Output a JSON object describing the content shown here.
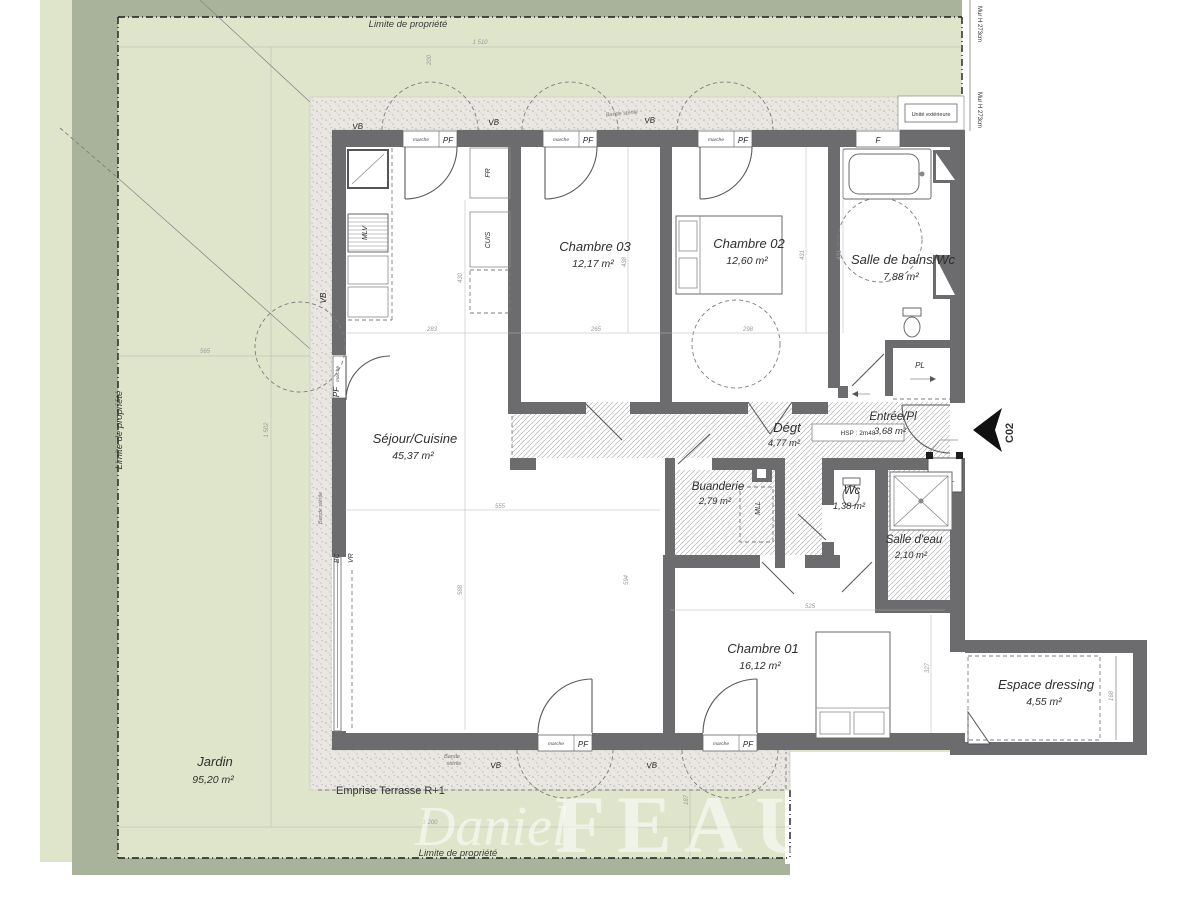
{
  "plan": {
    "code": "C02"
  },
  "garden": {
    "name": "Jardin",
    "area": "95,20 m²",
    "limite": "Limite de propriété",
    "emprise": "Emprise Terrasse R+1",
    "unite_exterieure": "Unité extérieure",
    "mur": "Mur H 273cm"
  },
  "rooms": [
    {
      "name": "Séjour/Cuisine",
      "area": "45,37 m²"
    },
    {
      "name": "Chambre 03",
      "area": "12,17 m²"
    },
    {
      "name": "Chambre 02",
      "area": "12,60 m²"
    },
    {
      "name": "Salle de bains/Wc",
      "area": "7,88 m²"
    },
    {
      "name": "Dégt",
      "area": "4,77 m²"
    },
    {
      "name": "Entrée/Pl",
      "area": "3,68 m²"
    },
    {
      "name": "Buanderie",
      "area": "2,79 m²"
    },
    {
      "name": "Wc",
      "area": "1,38 m²"
    },
    {
      "name": "Salle d'eau",
      "area": "2,10 m²"
    },
    {
      "name": "Chambre 01",
      "area": "16,12 m²"
    },
    {
      "name": "Espace dressing",
      "area": "4,55 m²"
    }
  ],
  "labels": {
    "pl": "PL",
    "etel": "ETEL",
    "hsp": "HSP : 2m48",
    "allege": "all. 115",
    "f": "F",
    "mlv": "MLV",
    "fr": "FR",
    "cuis": "CUIS",
    "mll": "MLL",
    "bc": "BC",
    "vr": "VR",
    "vb": "VB",
    "marche": "marche",
    "pf": "PF",
    "bande_sterile": "Bande stérile",
    "bande1": "Bande",
    "bande2": "stérile"
  },
  "dims": [
    "1 510",
    "200",
    "565",
    "1 502",
    "1 200",
    "187",
    "283",
    "265",
    "298",
    "430",
    "438",
    "431",
    "431",
    "555",
    "588",
    "594",
    "525",
    "327",
    "168"
  ],
  "watermark": {
    "first": "Daniel",
    "last": "FEAU"
  },
  "colors": {
    "garden": "#dfe5ca",
    "hedge": "#a9b29a",
    "wall": "#6c6c6e",
    "terrace": "#eae6e2",
    "hatch": "#b3b3b3",
    "propline": "#1c1c1c"
  }
}
